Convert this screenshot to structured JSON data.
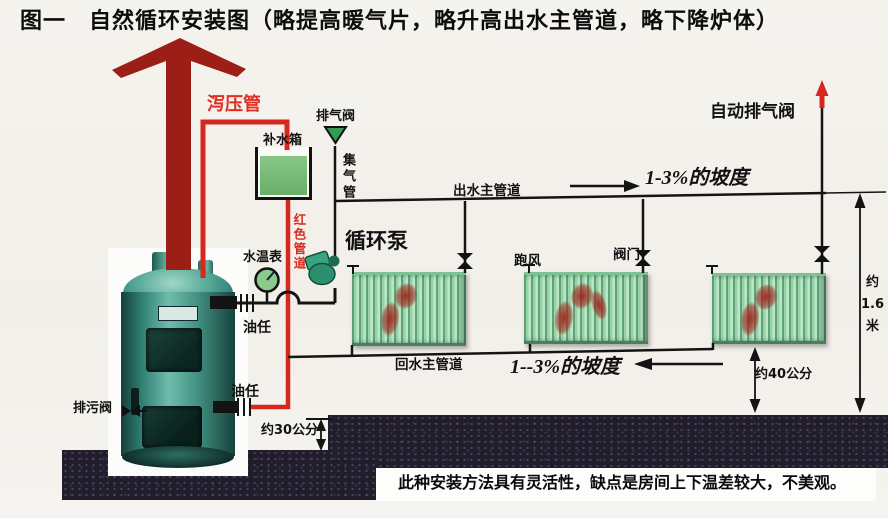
{
  "title": "图一　自然循环安装图（略提高暖气片，略升高出水主管道，略下降炉体）",
  "labels": {
    "relief_pipe": "泻压管",
    "exhaust_valve": "排气阀",
    "makeup_tank": "补水箱",
    "air_collector_pipe": "集气管",
    "red_pipe": "红色管道",
    "auto_exhaust_valve": "自动排气阀",
    "slope_top": "1-3%的坡度",
    "supply_main": "出水主管道",
    "circulation_pump": "循环泵",
    "thermometer": "水温表",
    "air_vent": "跑风",
    "valve": "阀门",
    "union_top": "油任",
    "union_bottom": "油任",
    "drain_valve": "排污阀",
    "return_main": "回水主管道",
    "slope_bottom": "1--3%的坡度",
    "dim_30cm": "约30公分",
    "dim_40cm": "约40公分",
    "dim_height_a": "约",
    "dim_height_b": "1.6",
    "dim_height_c": "米"
  },
  "note": "此种安装方法具有灵活性，缺点是房间上下温差较大，不美观。",
  "colors": {
    "pipe_red": "#d6281e",
    "arrow_dark_red": "#9b1f17",
    "pipe_black": "#141414",
    "water_green": "#74b974",
    "boiler_teal": "#3a9382",
    "radiator_green": "#97d2a9",
    "ground_dark": "#211d2b",
    "label_red": "#e12d22"
  }
}
